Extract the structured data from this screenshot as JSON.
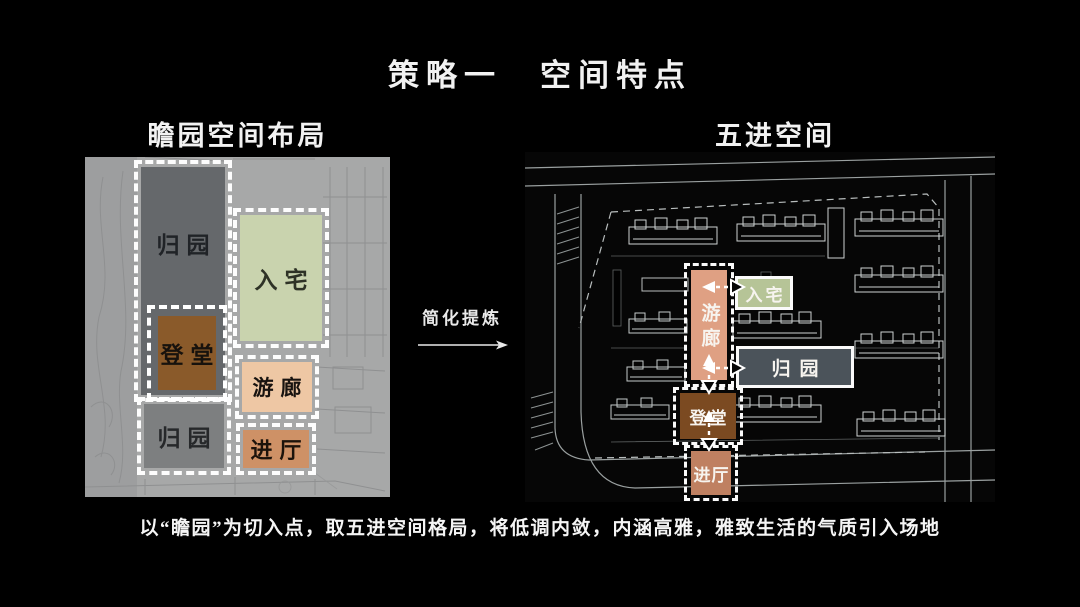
{
  "title": "策略一　空间特点",
  "left_panel": {
    "heading": "瞻园空间布局",
    "zones": {
      "guiyuan_top": "归园",
      "ruzhai": "入宅",
      "dengtang": "登堂",
      "youlang": "游廊",
      "guiyuan_bottom": "归园",
      "jinting": "进厅"
    }
  },
  "transition": {
    "label": "简化提炼"
  },
  "right_panel": {
    "heading": "五进空间",
    "zones": {
      "ruzhai": "入宅",
      "youlang": "游廊",
      "guiyuan": "归园",
      "dengtang": "登堂",
      "jinting": "进厅"
    }
  },
  "caption": "以“瞻园”为切入点，取五进空间格局，将低调内敛，内涵高雅，雅致生活的气质引入场地",
  "colors": {
    "background": "#000000",
    "text": "#f2f2f2",
    "left_plan_paper": "#a7a8a8",
    "left_guiyuan_dark": "#65686b",
    "left_guiyuan_light": "#7d7f80",
    "left_ruzhai_green": "#c9d3ae",
    "left_dengtang_brown": "#8a5a2a",
    "left_youlang_peach": "#eec7a4",
    "left_jinting_orange": "#ce9166",
    "right_youlang_salmon": "#dfa083",
    "right_ruzhai_green": "#b6c497",
    "right_guiyuan_slate": "#4b535a",
    "right_dengtang_brown": "#7b4a21",
    "right_jinting_salmon": "#bf8061",
    "cad_line": "#c7cccc"
  }
}
